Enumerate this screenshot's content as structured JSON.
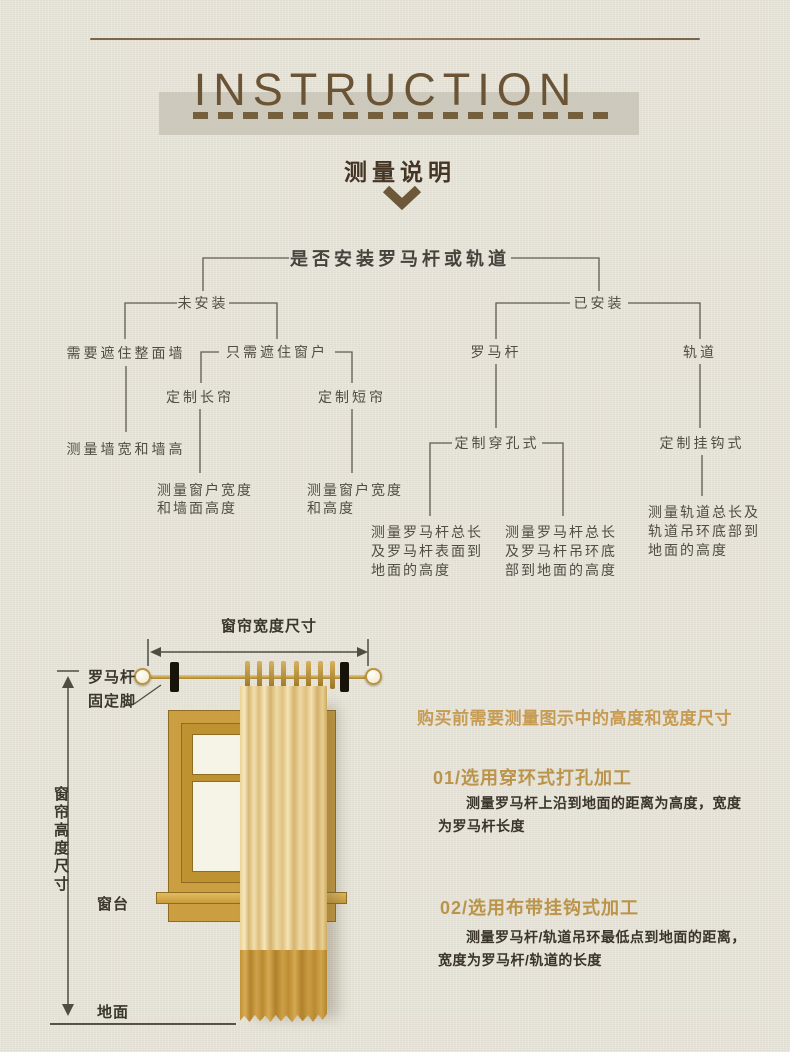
{
  "colors": {
    "background": "#e9e6db",
    "title_brown": "#6a5435",
    "subtitle_brown": "#443525",
    "flowchart_ink": "#504d45",
    "heading_gold": "#c79b52",
    "step_gold": "#bb9449",
    "body_dark": "#3a342b",
    "frame_gold": "#cb9e41",
    "curtain_gold": "#e3c27f",
    "curtain_band_gold": "#c0913a"
  },
  "header": {
    "title": "INSTRUCTION",
    "subtitle": "测量说明"
  },
  "flowchart": {
    "root": "是否安装罗马杆或轨道",
    "not_installed": {
      "label": "未安装",
      "cover_wall": "需要遮住整面墙",
      "cover_wall_measure": "测量墙宽和墙高",
      "cover_window": "只需遮住窗户",
      "long_curtain": "定制长帘",
      "long_curtain_measure": "测量窗户宽度\n和墙面高度",
      "short_curtain": "定制短帘",
      "short_curtain_measure": "测量窗户宽度\n和高度"
    },
    "installed": {
      "label": "已安装",
      "rod": "罗马杆",
      "rod_style": "定制穿孔式",
      "rod_measure_surface": "测量罗马杆总长\n及罗马杆表面到\n地面的高度",
      "rod_measure_ring": "测量罗马杆总长\n及罗马杆吊环底\n部到地面的高度",
      "track": "轨道",
      "track_style": "定制挂钩式",
      "track_measure": "测量轨道总长及\n轨道吊环底部到\n地面的高度"
    }
  },
  "diagram": {
    "width_label": "窗帘宽度尺寸",
    "height_label": "窗帘高度尺寸",
    "rod_label": "罗马杆",
    "rod_foot_label": "固定脚",
    "sill_label": "窗台",
    "floor_label": "地面"
  },
  "notes": {
    "intro": "购买前需要测量图示中的高度和宽度尺寸",
    "step1_title": "01/选用穿环式打孔加工",
    "step1_body": "测量罗马杆上沿到地面的距离为高度，宽度为罗马杆长度",
    "step2_title": "02/选用布带挂钩式加工",
    "step2_body": "测量罗马杆/轨道吊环最低点到地面的距离，宽度为罗马杆/轨道的长度"
  }
}
